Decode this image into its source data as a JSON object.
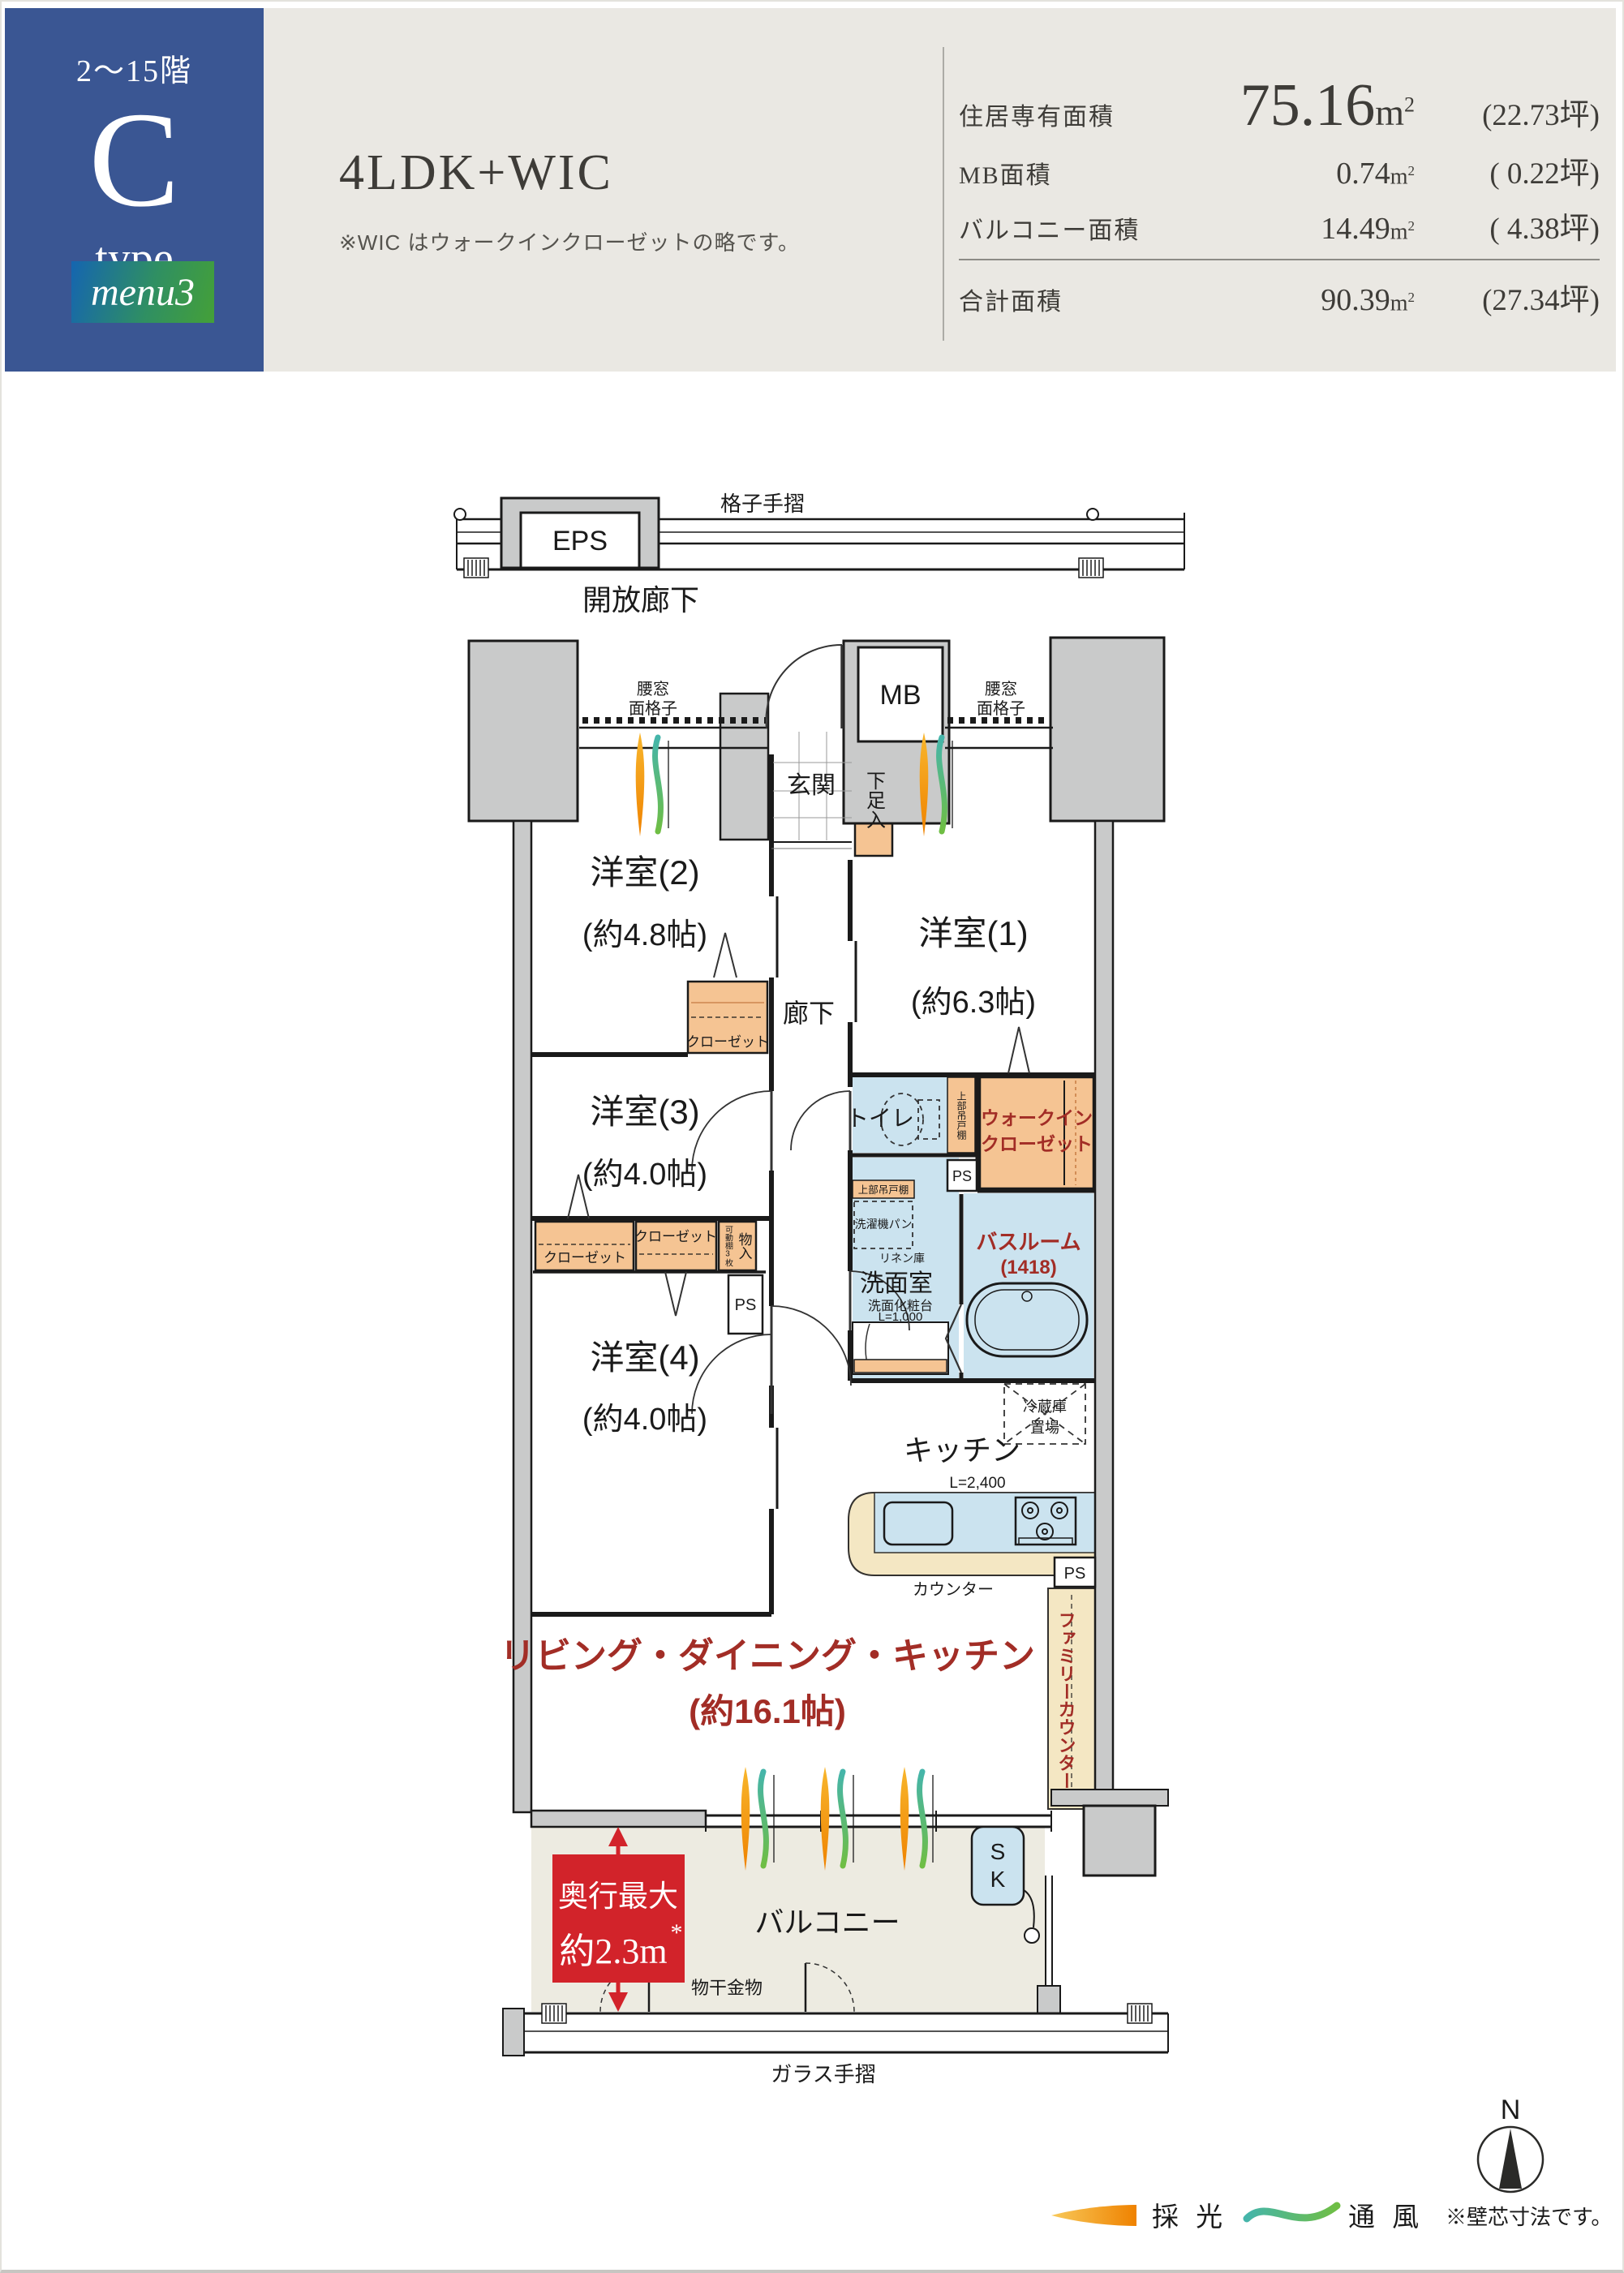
{
  "badge": {
    "floors": "2〜15階",
    "letter": "C",
    "word": "type",
    "menu": "menu3",
    "navy": "#3A5693",
    "menu_blue": "#1565B0",
    "menu_green": "#44A038"
  },
  "title": {
    "layout": "4LDK+WIC",
    "note": "※WIC はウォークインクローゼットの略です。"
  },
  "areas": {
    "unit": "m",
    "sup": "2",
    "rows": [
      {
        "label": "住居専有面積",
        "num": "75.16",
        "tsubo": "(22.73坪)"
      },
      {
        "label": "MB面積",
        "num": "0.74",
        "tsubo": "( 0.22坪)"
      },
      {
        "label": "バルコニー面積",
        "num": "14.49",
        "tsubo": "( 4.38坪)"
      }
    ],
    "total": {
      "label": "合計面積",
      "num": "90.39",
      "tsubo": "(27.34坪)"
    }
  },
  "plan": {
    "colors": {
      "closet_orange": "#F5C493",
      "wet_blue": "#CBE3EF",
      "counter_beige": "#F4E7C3",
      "column_gray": "#C9CACA",
      "balcony_floor": "#EDEBE1",
      "label_red": "#A22D26",
      "accent_red": "#D2232A",
      "daylight_orange": "#EF8200",
      "vent_green": "#6FBE44"
    },
    "labels": {
      "eps": "EPS",
      "latticeRail": "格子手摺",
      "openCorridor": "開放廊下",
      "win1a": "腰窓",
      "win1b": "面格子",
      "win2a": "腰窓",
      "win2b": "面格子",
      "mb": "MB",
      "genkan": "玄関",
      "getabako": "下足入",
      "y2n": "洋室(2)",
      "y2s": "(約4.8帖)",
      "y1n": "洋室(1)",
      "y1s": "(約6.3帖)",
      "y3n": "洋室(3)",
      "y3s": "(約4.0帖)",
      "y4n": "洋室(4)",
      "y4s": "(約4.0帖)",
      "corridor": "廊下",
      "closetA": "クローゼット",
      "closetB": "クローゼット",
      "closetC": "クローゼット",
      "monoire": "物入",
      "kadodana": "可動棚3枚",
      "psA": "PS",
      "psB": "PS",
      "psC": "PS",
      "toilet": "トイレ",
      "tsuridanaT": "上部吊戸棚",
      "wic1": "ウォークイン",
      "wic2": "クローゼット",
      "tsuridanaW": "上部吊戸棚",
      "sentakuki": "洗濯機パン",
      "linen": "リネン庫",
      "senmen": "洗面室",
      "vanity1": "洗面化粧台",
      "vanity2": "L=1,000",
      "bath1": "バスルーム",
      "bath2": "(1418)",
      "fridge1": "冷蔵庫",
      "fridge2": "置場",
      "kitchen": "キッチン",
      "l2400": "L=2,400",
      "counter": "カウンター",
      "familyCounter": "ファミリーカウンター",
      "ldk1": "リビング・ダイニング・キッチン",
      "ldk2": "(約16.1帖)",
      "depth1": "奥行最大",
      "depth2": "約2.3m",
      "depthAst": "*",
      "balcony": "バルコニー",
      "monohoshi": "物干金物",
      "glassRail": "ガラス手摺",
      "skS": "S",
      "skK": "K"
    }
  },
  "legend": {
    "daylight": "採 光",
    "ventilation": "通 風",
    "wallNote": "※壁芯寸法です。",
    "north": "N"
  }
}
